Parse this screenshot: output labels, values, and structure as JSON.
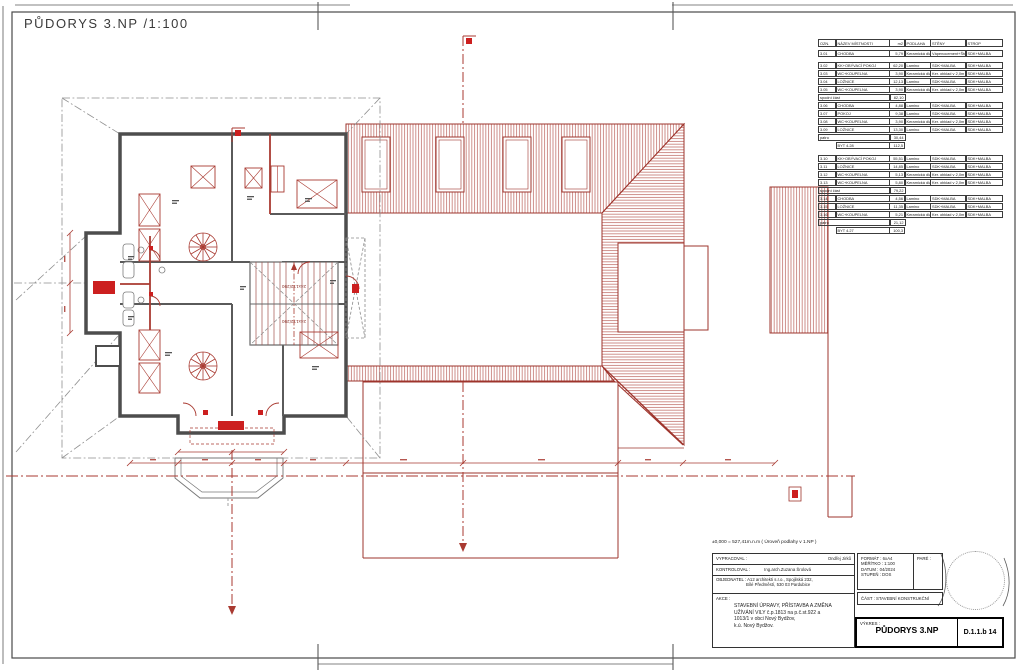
{
  "sheet": {
    "plan_title": "PŮDORYS 3.NP /1:100",
    "legend_title": "LEGENDA MÍSTNOSTÍ 3.NP"
  },
  "plan": {
    "stair_label": "24x172/290",
    "colors": {
      "annotation_red": "#a93a31",
      "new_construction_red": "#cc1f1f",
      "wall_gray": "#4d4d4d"
    }
  },
  "legend": {
    "columns": [
      "OZN.",
      "NÁZEV MÍSTNOSTI",
      "m2",
      "PODLAHA",
      "STĚNY",
      "STROP"
    ],
    "blocks": [
      {
        "rows": [
          {
            "type": "room",
            "cells": [
              "3.01",
              "CHODBA",
              "5,79",
              "Keramická dlažba",
              "Vápenocement+Štuk",
              "SDK+MALBA"
            ]
          }
        ]
      },
      {
        "rows": [
          {
            "type": "room",
            "cells": [
              "3.02",
              "KK+OBÝVACÍ POKOJ",
              "62,20",
              "Lamino",
              "SDK+MALBA",
              "SDK+MALBA"
            ]
          },
          {
            "type": "room",
            "cells": [
              "3.03",
              "WC+KOUPELNA",
              "3,90",
              "Keramická dlažba",
              "Ker. obklad v 2,0m",
              "SDK+MALBA"
            ]
          },
          {
            "type": "room",
            "cells": [
              "3.04",
              "LOŽNICE",
              "12,13",
              "Lamino",
              "SDK+MALBA",
              "SDK+MALBA"
            ]
          },
          {
            "type": "room",
            "cells": [
              "3.05",
              "WC+KOUPELNA",
              "3,90",
              "Keramická dlažba",
              "Ker. obklad v 2,0m",
              "SDK+MALBA"
            ]
          },
          {
            "type": "subtotal",
            "label": "spodní část",
            "value": "82,10"
          },
          {
            "type": "room",
            "cells": [
              "3.06",
              "CHODBA",
              "4,88",
              "Lamino",
              "SDK+MALBA",
              "SDK+MALBA"
            ]
          },
          {
            "type": "room",
            "cells": [
              "3.07",
              "POKOJ",
              "9,38",
              "Lamino",
              "SDK+MALBA",
              "SDK+MALBA"
            ]
          },
          {
            "type": "room",
            "cells": [
              "3.08",
              "WC+KOUPELNA",
              "3,90",
              "Keramická dlažba",
              "Ker. obklad v 2,0m",
              "SDK+MALBA"
            ]
          },
          {
            "type": "room",
            "cells": [
              "3.09",
              "LOŽNICE",
              "13,30",
              "Lamino",
              "SDK+MALBA",
              "SDK+MALBA"
            ]
          },
          {
            "type": "subtotal",
            "label": "patro",
            "value": "30,44"
          },
          {
            "type": "total",
            "label": "BYT 4.28",
            "value": "112,5"
          }
        ]
      },
      {
        "rows": [
          {
            "type": "room",
            "cells": [
              "3.10",
              "KK+OBÝVACÍ POKOJ",
              "55,51",
              "Lamino",
              "SDK+MALBA",
              "SDK+MALBA"
            ]
          },
          {
            "type": "room",
            "cells": [
              "3.11",
              "LOŽNICE",
              "14,85",
              "Lamino",
              "SDK+MALBA",
              "SDK+MALBA"
            ]
          },
          {
            "type": "room",
            "cells": [
              "3.12",
              "WC+KOUPELNA",
              "5,13",
              "Keramická dlažba",
              "Ker. obklad v 2,0m",
              "SDK+MALBA"
            ]
          },
          {
            "type": "room",
            "cells": [
              "3.13",
              "WC+KOUPELNA",
              "5,80",
              "Keramická dlažba",
              "Ker. obklad v 2,0m",
              "SDK+MALBA"
            ]
          },
          {
            "type": "subtotal",
            "label": "spodní část",
            "value": "79,22"
          },
          {
            "type": "room",
            "cells": [
              "3.14",
              "CHODBA",
              "4,56",
              "Lamino",
              "SDK+MALBA",
              "SDK+MALBA"
            ]
          },
          {
            "type": "room",
            "cells": [
              "3.15",
              "LOŽNICE",
              "11,35",
              "Lamino",
              "SDK+MALBA",
              "SDK+MALBA"
            ]
          },
          {
            "type": "room",
            "cells": [
              "3.16",
              "WC+KOUPELNA",
              "5,21",
              "Keramická dlažba",
              "Ker. obklad v 2,0m",
              "SDK+MALBA"
            ]
          },
          {
            "type": "subtotal",
            "label": "patro",
            "value": "21,12"
          },
          {
            "type": "total",
            "label": "BYT 4.27",
            "value": "100,3"
          }
        ]
      }
    ]
  },
  "titleblock": {
    "elevation_note": "±0,000 = 527,41m.n.m ( Úroveň podlahy v 1.NP )",
    "vypracoval_label": "VYPRACOVAL :",
    "vypracoval": "Ondřej Jirků",
    "kontroloval_label": "KONTROLOVAL :",
    "kontroloval": "Ing.arch.Zuzana Šrolová",
    "objednatel_label": "OBJEDNATEL :",
    "objednatel_line1": "A12 architekti s.r.o., Spojilská 232,",
    "objednatel_line2": "Bílé Předměstí, 530 03 Pardubice",
    "akce_label": "AKCE :",
    "akce_line1": "STAVEBNÍ ÚPRAVY, PŘÍSTAVBA A ZMĚNA",
    "akce_line2": "UŽÍVÁNÍ VILY č.p.1813 na p.č.st.922 a",
    "akce_line3": "1013/1 v obci Nový Bydžov,",
    "akce_line4": "k.ú. Nový Bydžov.",
    "format_label": "FORMÁT :",
    "format": "6xA4",
    "meritko_label": "MĚŘÍTKO :",
    "meritko": "1:100",
    "datum_label": "DATUM :",
    "datum": "04/2024",
    "stupen_label": "STUPEŇ :",
    "stupen": "DOS",
    "pare_label": "PARÉ :",
    "cast_label": "ČÁST :",
    "cast": "STAVEBNÍ KONSTRUKČNÍ",
    "vykres_label": "VÝKRES :",
    "vykres": "PŮDORYS 3.NP",
    "drawing_number": "D.1.1.b 14"
  }
}
